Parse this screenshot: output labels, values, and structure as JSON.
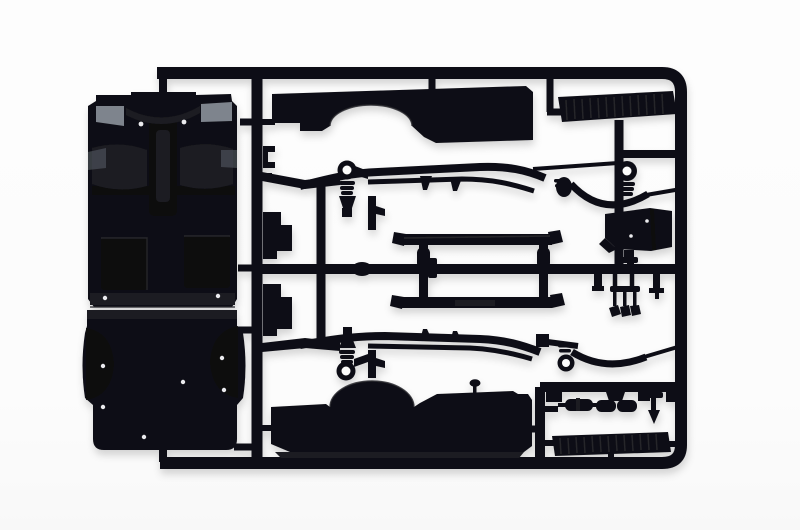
{
  "image": {
    "type": "product-photo",
    "subject": "Black injection-molded plastic model kit sprue (parts tree) with truck cab floor, cargo bed floor, side panels, chassis rails, running boards and small chassis parts, photographed on a white background",
    "background_color": "#fcfcfc",
    "colors": {
      "plastic": "#111116",
      "plastic_light": "#1c1c22",
      "plastic_dark": "#0a0a0d",
      "recess": "#0d0d12",
      "highlight_gray": "#7e848d",
      "highlight_gray_dark": "#5a6068",
      "ejector_mark": "#eaeaee",
      "seam": "#45454c",
      "sheen": "#2a2a31",
      "hole": "#fcfcfc"
    }
  },
  "parts": [
    {
      "id": "sprue-frame",
      "label": "Sprue runner frame"
    },
    {
      "id": "cab-floor-pan",
      "label": "Cab floor pan with transmission tunnel and wheel humps"
    },
    {
      "id": "cargo-bed-floor",
      "label": "Cargo bed floor with fender bulges"
    },
    {
      "id": "side-panel-upper",
      "label": "Bed side panel with wheel arch (top)"
    },
    {
      "id": "side-panel-lower",
      "label": "Bed side panel with wheel arch (bottom)"
    },
    {
      "id": "running-board-upper",
      "label": "Ribbed running board (top right)"
    },
    {
      "id": "running-board-lower",
      "label": "Ribbed running board (bottom right)"
    },
    {
      "id": "chassis-rail-upper",
      "label": "Chassis side rail with shackle eyes, bump stops and hangers"
    },
    {
      "id": "chassis-rail-lower",
      "label": "Chassis side rail with shackle eyes, bump stops and hangers"
    },
    {
      "id": "bed-frame-rails",
      "label": "Bed frame cross rails (ladder)"
    },
    {
      "id": "tank-box",
      "label": "Tank / air-cleaner box"
    },
    {
      "id": "pedal-set",
      "label": "Pedal cluster (three pedals)"
    },
    {
      "id": "muffler",
      "label": "Muffler capsule"
    },
    {
      "id": "axle-assembly",
      "label": "Axle and differential assembly"
    },
    {
      "id": "linkage-part",
      "label": "Linkage with spade end"
    },
    {
      "id": "stepped-brackets",
      "label": "Stepped mounting brackets"
    },
    {
      "id": "shock-absorbers",
      "label": "Shock absorber stubs"
    },
    {
      "id": "shift-lever",
      "label": "Shift lever with round knob"
    }
  ]
}
